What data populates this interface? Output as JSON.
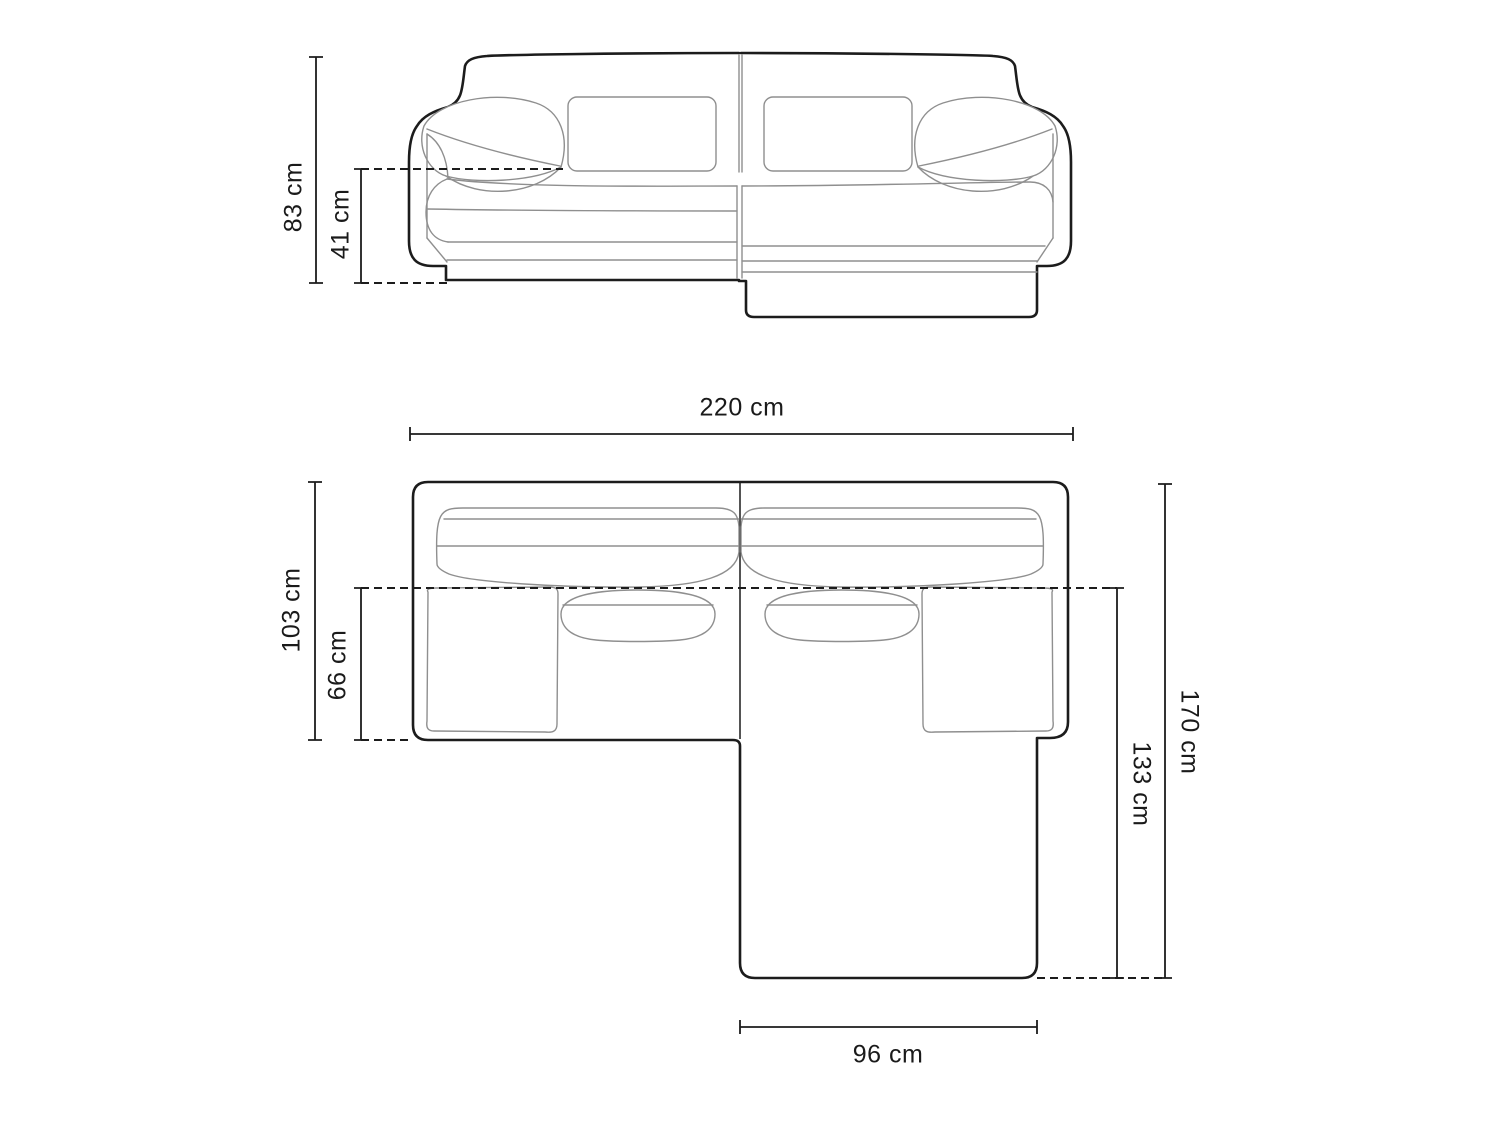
{
  "diagram_title": "corner-sofa-dimension-drawing",
  "dimensions": {
    "overall_height": "83 cm",
    "seat_height": "41 cm",
    "overall_width": "220 cm",
    "overall_depth": "103 cm",
    "seat_depth": "66 cm",
    "total_depth": "170 cm",
    "chaise_depth": "133 cm",
    "chaise_width": "96 cm"
  },
  "colors": {
    "outline": "#1c1c1c",
    "seam": "#8f8f8f",
    "background": "#ffffff",
    "label": "#1a1a1a"
  }
}
